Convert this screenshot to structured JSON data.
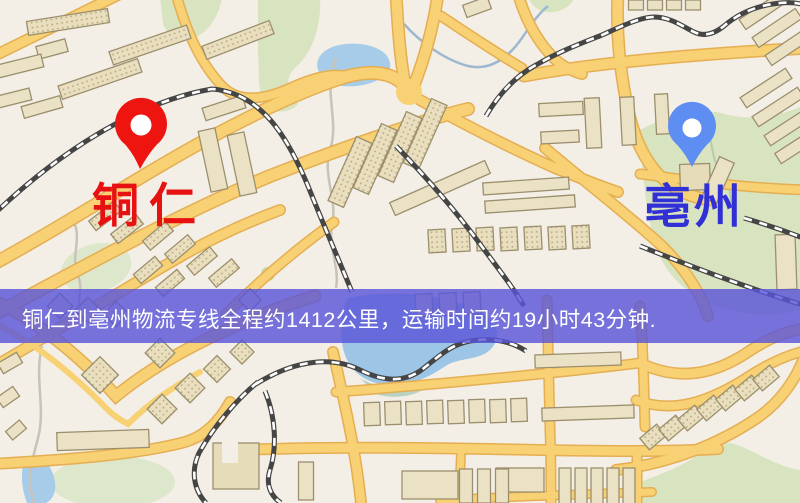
{
  "route_map": {
    "origin": {
      "name": "铜仁",
      "label_color": "#e81111",
      "pin_color": "#ee1510"
    },
    "destination": {
      "name": "亳州",
      "label_color": "#3030d6",
      "pin_color": "#5f8ef3"
    },
    "banner": {
      "text": "铜仁到亳州物流专线全程约1412公里，运输时间约19小时43分钟.",
      "distance_text": "约1412公里",
      "duration_text": "约19小时43分钟",
      "bg_color": "#5a55d8",
      "text_color": "#ffffff"
    }
  }
}
